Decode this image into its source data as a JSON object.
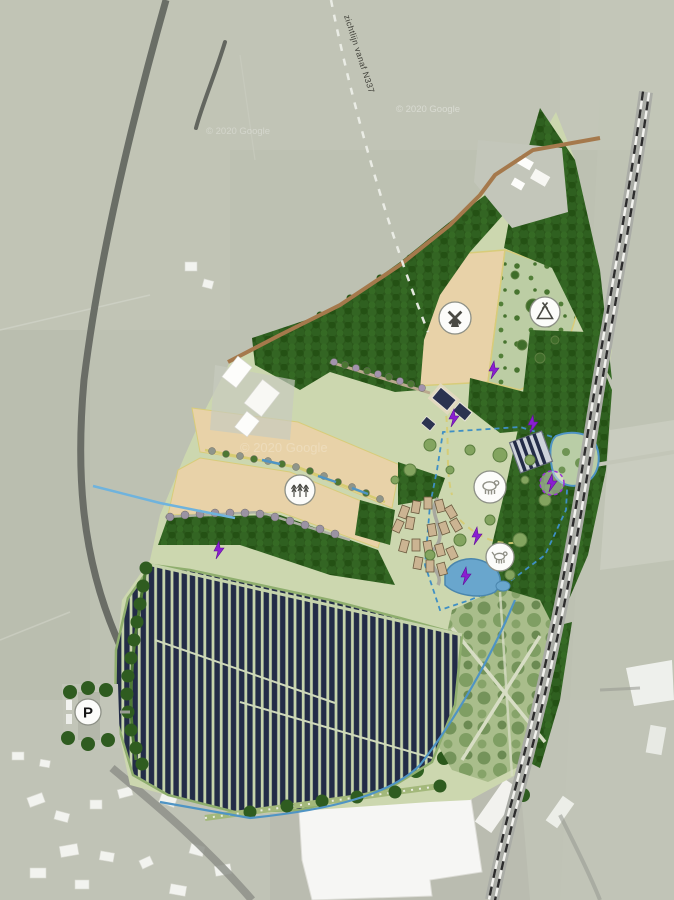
{
  "map": {
    "kind": "landscape-master-plan-over-aerial-photo",
    "sightline_label": "zichtlijn vanaf N337",
    "parking_label": "P",
    "watermarks": [
      {
        "text": "© 2020 Google"
      },
      {
        "text": "© 2020 Google"
      },
      {
        "text": "© 2020 Google"
      }
    ]
  },
  "markers": [
    {
      "id": "windmill",
      "icon": "windmill-icon"
    },
    {
      "id": "tent",
      "icon": "tent-icon"
    },
    {
      "id": "orchard",
      "icon": "trees-icon"
    },
    {
      "id": "livestock",
      "icon": "sheep-icon"
    },
    {
      "id": "dog-meadow",
      "icon": "dog-icon"
    },
    {
      "id": "parking",
      "icon": "parking-icon",
      "label": "P"
    }
  ],
  "energy_markers": {
    "icon": "lightning-bolt-icon",
    "count": 7,
    "color": "#8a1fd1"
  },
  "colors": {
    "aerial": "#bdc1b2",
    "forest": "#2b581b",
    "meadow": "#ccd7af",
    "field_tan": "#e8d2a8",
    "field_dotted": "#bccda4",
    "park_olive": "#a9bd8b",
    "solar_panel": "#232c47",
    "solar_ground": "#c6d4ac",
    "water": "#69a6cd",
    "water_line": "#4f94c4",
    "path_brown": "#a5794c",
    "path_yellow": "#d8cc7a",
    "road": "#63665f",
    "railway": "#aaaca6",
    "bolt": "#8a1fd1",
    "building_white": "#f5f5f2",
    "cabin": "#cbb492",
    "dark_roof": "#2b3350"
  }
}
